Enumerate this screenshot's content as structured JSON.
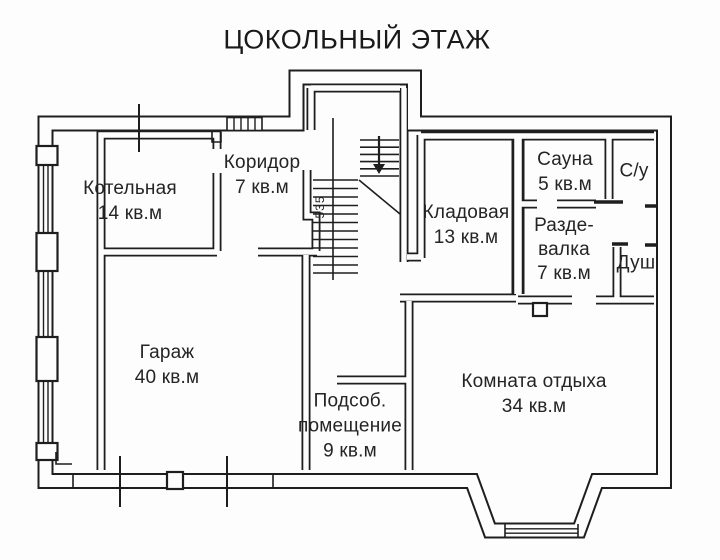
{
  "title": "ЦОКОЛЬНЫЙ ЭТАЖ",
  "rooms": [
    {
      "id": "kotelnaya",
      "label": "Котельная\n14 кв.м"
    },
    {
      "id": "koridor",
      "label": "Коридор\n7 кв.м"
    },
    {
      "id": "kladovaya",
      "label": "Кладовая\n13 кв.м"
    },
    {
      "id": "sauna",
      "label": "Сауна\n5 кв.м"
    },
    {
      "id": "su",
      "label": "С/у"
    },
    {
      "id": "razdevalka",
      "label": "Разде-\nвалка\n7 кв.м"
    },
    {
      "id": "dush",
      "label": "Душ"
    },
    {
      "id": "garazh",
      "label": "Гараж\n40 кв.м"
    },
    {
      "id": "podsob",
      "label": "Подсоб.\nпомещение\n9 кв.м"
    },
    {
      "id": "komnata_otdyha",
      "label": "Комната отдыха\n34 кв.м"
    }
  ],
  "dimensions": {
    "stair_width": "535"
  },
  "colors": {
    "line": "#1e1e1e",
    "background": "#fdfdfd",
    "text": "#242424"
  }
}
